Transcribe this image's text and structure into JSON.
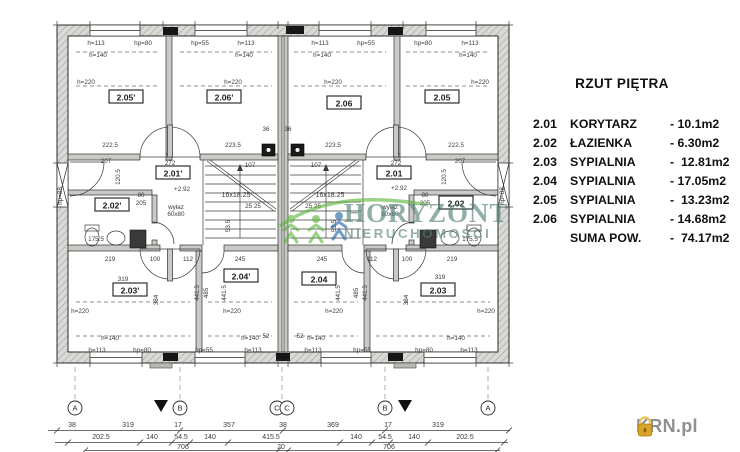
{
  "legend": {
    "title": "RZUT PIĘTRA",
    "separator": "-",
    "rows": [
      {
        "code": "2.01",
        "name": "KORYTARZ",
        "area": "10.1m2"
      },
      {
        "code": "2.02",
        "name": "ŁAZIENKA",
        "area": "6.30m2"
      },
      {
        "code": "2.03",
        "name": "SYPIALNIA",
        "area": "12.81m2"
      },
      {
        "code": "2.04",
        "name": "SYPIALNIA",
        "area": "17.05m2"
      },
      {
        "code": "2.05",
        "name": "SYPIALNIA",
        "area": "13.23m2"
      },
      {
        "code": "2.06",
        "name": "SYPIALNIA",
        "area": "14.68m2"
      }
    ],
    "total_label": "SUMA POW.",
    "total_area": "74.17m2"
  },
  "watermark": {
    "line1": "HORYZONT",
    "line2": "NIERUCHOMOŚCI",
    "text_color": "#517e76",
    "arc_color": "#5cb53c",
    "figure_colors": [
      "#5cb53c",
      "#5cb53c",
      "#1f63a8"
    ]
  },
  "branding": {
    "text": "KRN.pl",
    "icon": "house-icon",
    "icon_color": "#d9a42a",
    "text_color": "#8f8f8f"
  },
  "plan": {
    "room_labels": [
      {
        "t": "2.05'",
        "x": 126,
        "y": 99
      },
      {
        "t": "2.06'",
        "x": 224,
        "y": 99
      },
      {
        "t": "2.01'",
        "x": 173,
        "y": 175
      },
      {
        "t": "2.02'",
        "x": 112,
        "y": 207
      },
      {
        "t": "2.03'",
        "x": 130,
        "y": 292
      },
      {
        "t": "2.04'",
        "x": 241,
        "y": 278
      },
      {
        "t": "2.06",
        "x": 344,
        "y": 105
      },
      {
        "t": "2.05",
        "x": 442,
        "y": 99
      },
      {
        "t": "2.01",
        "x": 394,
        "y": 175
      },
      {
        "t": "2.02",
        "x": 456,
        "y": 205
      },
      {
        "t": "2.03",
        "x": 438,
        "y": 292
      },
      {
        "t": "2.04",
        "x": 319,
        "y": 281
      }
    ],
    "axis_markers": [
      {
        "l": "A",
        "x": 75
      },
      {
        "l": "B",
        "x": 180
      },
      {
        "l": "C",
        "x": 277
      },
      {
        "l": "C",
        "x": 287
      },
      {
        "l": "B",
        "x": 385
      },
      {
        "l": "A",
        "x": 488
      }
    ],
    "dim_labels": [
      {
        "t": "h=113",
        "x": 96,
        "y": 45
      },
      {
        "t": "hp=80",
        "x": 143,
        "y": 45
      },
      {
        "t": "hp=55",
        "x": 200,
        "y": 45
      },
      {
        "t": "h=113",
        "x": 246,
        "y": 45
      },
      {
        "t": "h=113",
        "x": 320,
        "y": 45
      },
      {
        "t": "hp=55",
        "x": 366,
        "y": 45
      },
      {
        "t": "hp=80",
        "x": 423,
        "y": 45
      },
      {
        "t": "h=113",
        "x": 470,
        "y": 45
      },
      {
        "t": "h=140",
        "x": 98,
        "y": 57
      },
      {
        "t": "h=140",
        "x": 244,
        "y": 57
      },
      {
        "t": "h=140",
        "x": 322,
        "y": 57
      },
      {
        "t": "h=140",
        "x": 468,
        "y": 57
      },
      {
        "t": "h=220",
        "x": 86,
        "y": 84
      },
      {
        "t": "h=220",
        "x": 233,
        "y": 84
      },
      {
        "t": "h=220",
        "x": 333,
        "y": 84
      },
      {
        "t": "h=220",
        "x": 480,
        "y": 84
      },
      {
        "t": "222.5",
        "x": 110,
        "y": 147
      },
      {
        "t": "223.5",
        "x": 233,
        "y": 147
      },
      {
        "t": "223.5",
        "x": 333,
        "y": 147
      },
      {
        "t": "222.5",
        "x": 456,
        "y": 147
      },
      {
        "t": "36",
        "x": 266,
        "y": 131
      },
      {
        "t": "36",
        "x": 288,
        "y": 131
      },
      {
        "t": "207",
        "x": 106,
        "y": 163
      },
      {
        "t": "207",
        "x": 460,
        "y": 163
      },
      {
        "t": "107",
        "x": 250,
        "y": 167
      },
      {
        "t": "107",
        "x": 316,
        "y": 167
      },
      {
        "t": "272",
        "x": 170,
        "y": 165
      },
      {
        "t": "272",
        "x": 396,
        "y": 165
      },
      {
        "t": "16x18.25",
        "x": 236,
        "y": 197,
        "s": 7
      },
      {
        "t": "16x18.25",
        "x": 330,
        "y": 197,
        "s": 7
      },
      {
        "t": "25  25",
        "x": 253,
        "y": 208
      },
      {
        "t": "25  25",
        "x": 313,
        "y": 208
      },
      {
        "t": "+2.92",
        "x": 182,
        "y": 191
      },
      {
        "t": "+2.92",
        "x": 399,
        "y": 190
      },
      {
        "t": "wyłaz",
        "x": 176,
        "y": 209
      },
      {
        "t": "60x80",
        "x": 176,
        "y": 216
      },
      {
        "t": "wyłaz",
        "x": 390,
        "y": 209
      },
      {
        "t": "60x80",
        "x": 390,
        "y": 216
      },
      {
        "t": "hp=88",
        "x": 62,
        "y": 196,
        "r": -90
      },
      {
        "t": "hp=88",
        "x": 504,
        "y": 196,
        "r": -90
      },
      {
        "t": "80",
        "x": 141,
        "y": 197
      },
      {
        "t": "205",
        "x": 141,
        "y": 205
      },
      {
        "t": "80",
        "x": 425,
        "y": 197
      },
      {
        "t": "205",
        "x": 425,
        "y": 205
      },
      {
        "t": "175.5",
        "x": 96,
        "y": 241
      },
      {
        "t": "175.5",
        "x": 470,
        "y": 241
      },
      {
        "t": "120.5",
        "x": 120,
        "y": 177,
        "r": -90
      },
      {
        "t": "120.5",
        "x": 446,
        "y": 177,
        "r": -90
      },
      {
        "t": "53.5",
        "x": 230,
        "y": 226,
        "r": -90
      },
      {
        "t": "53.5",
        "x": 336,
        "y": 226,
        "r": -90
      },
      {
        "t": "219",
        "x": 110,
        "y": 261
      },
      {
        "t": "100",
        "x": 155,
        "y": 261
      },
      {
        "t": "112",
        "x": 188,
        "y": 261
      },
      {
        "t": "245",
        "x": 240,
        "y": 261
      },
      {
        "t": "245",
        "x": 322,
        "y": 261
      },
      {
        "t": "112",
        "x": 372,
        "y": 261
      },
      {
        "t": "100",
        "x": 407,
        "y": 261
      },
      {
        "t": "219",
        "x": 452,
        "y": 261
      },
      {
        "t": "319",
        "x": 123,
        "y": 281
      },
      {
        "t": "319",
        "x": 440,
        "y": 279
      },
      {
        "t": "441.5",
        "x": 199,
        "y": 293,
        "r": -90
      },
      {
        "t": "485",
        "x": 208,
        "y": 293,
        "r": -90
      },
      {
        "t": "441.5",
        "x": 226,
        "y": 293,
        "r": -90
      },
      {
        "t": "441.5",
        "x": 340,
        "y": 293,
        "r": -90
      },
      {
        "t": "485",
        "x": 358,
        "y": 293,
        "r": -90
      },
      {
        "t": "441.5",
        "x": 367,
        "y": 293,
        "r": -90
      },
      {
        "t": "384",
        "x": 158,
        "y": 300,
        "r": -90
      },
      {
        "t": "384",
        "x": 408,
        "y": 300,
        "r": -90
      },
      {
        "t": "52",
        "x": 266,
        "y": 338
      },
      {
        "t": "52",
        "x": 300,
        "y": 338
      },
      {
        "t": "h=220",
        "x": 80,
        "y": 313
      },
      {
        "t": "h=220",
        "x": 232,
        "y": 313
      },
      {
        "t": "h=220",
        "x": 334,
        "y": 313
      },
      {
        "t": "h=220",
        "x": 486,
        "y": 313
      },
      {
        "t": "h=140",
        "x": 110,
        "y": 340
      },
      {
        "t": "h=140",
        "x": 250,
        "y": 340
      },
      {
        "t": "h=140",
        "x": 316,
        "y": 340
      },
      {
        "t": "h=140",
        "x": 456,
        "y": 340
      },
      {
        "t": "h=113",
        "x": 97,
        "y": 352
      },
      {
        "t": "hp=80",
        "x": 142,
        "y": 352
      },
      {
        "t": "hp=55",
        "x": 204,
        "y": 352
      },
      {
        "t": "h=113",
        "x": 253,
        "y": 352
      },
      {
        "t": "h=113",
        "x": 313,
        "y": 352
      },
      {
        "t": "hp=55",
        "x": 362,
        "y": 352
      },
      {
        "t": "hp=80",
        "x": 424,
        "y": 352
      },
      {
        "t": "h=113",
        "x": 469,
        "y": 352
      },
      {
        "t": "38",
        "x": 72,
        "y": 427,
        "s": 7
      },
      {
        "t": "319",
        "x": 128,
        "y": 427,
        "s": 7
      },
      {
        "t": "17",
        "x": 178,
        "y": 427,
        "s": 7
      },
      {
        "t": "357",
        "x": 229,
        "y": 427,
        "s": 7
      },
      {
        "t": "38",
        "x": 283,
        "y": 427,
        "s": 7
      },
      {
        "t": "369",
        "x": 333,
        "y": 427,
        "s": 7
      },
      {
        "t": "17",
        "x": 388,
        "y": 427,
        "s": 7
      },
      {
        "t": "319",
        "x": 438,
        "y": 427,
        "s": 7
      },
      {
        "t": "202.5",
        "x": 101,
        "y": 439,
        "s": 7
      },
      {
        "t": "140",
        "x": 152,
        "y": 439,
        "s": 7
      },
      {
        "t": "54.5",
        "x": 181,
        "y": 439,
        "s": 7
      },
      {
        "t": "140",
        "x": 210,
        "y": 439,
        "s": 7
      },
      {
        "t": "415.5",
        "x": 271,
        "y": 439,
        "s": 7
      },
      {
        "t": "140",
        "x": 356,
        "y": 439,
        "s": 7
      },
      {
        "t": "54.5",
        "x": 385,
        "y": 439,
        "s": 7
      },
      {
        "t": "140",
        "x": 414,
        "y": 439,
        "s": 7
      },
      {
        "t": "202.5",
        "x": 465,
        "y": 439,
        "s": 7
      },
      {
        "t": "706",
        "x": 183,
        "y": 449,
        "s": 7
      },
      {
        "t": "20",
        "x": 281,
        "y": 449,
        "s": 7
      },
      {
        "t": "706",
        "x": 389,
        "y": 449,
        "s": 7
      }
    ]
  }
}
